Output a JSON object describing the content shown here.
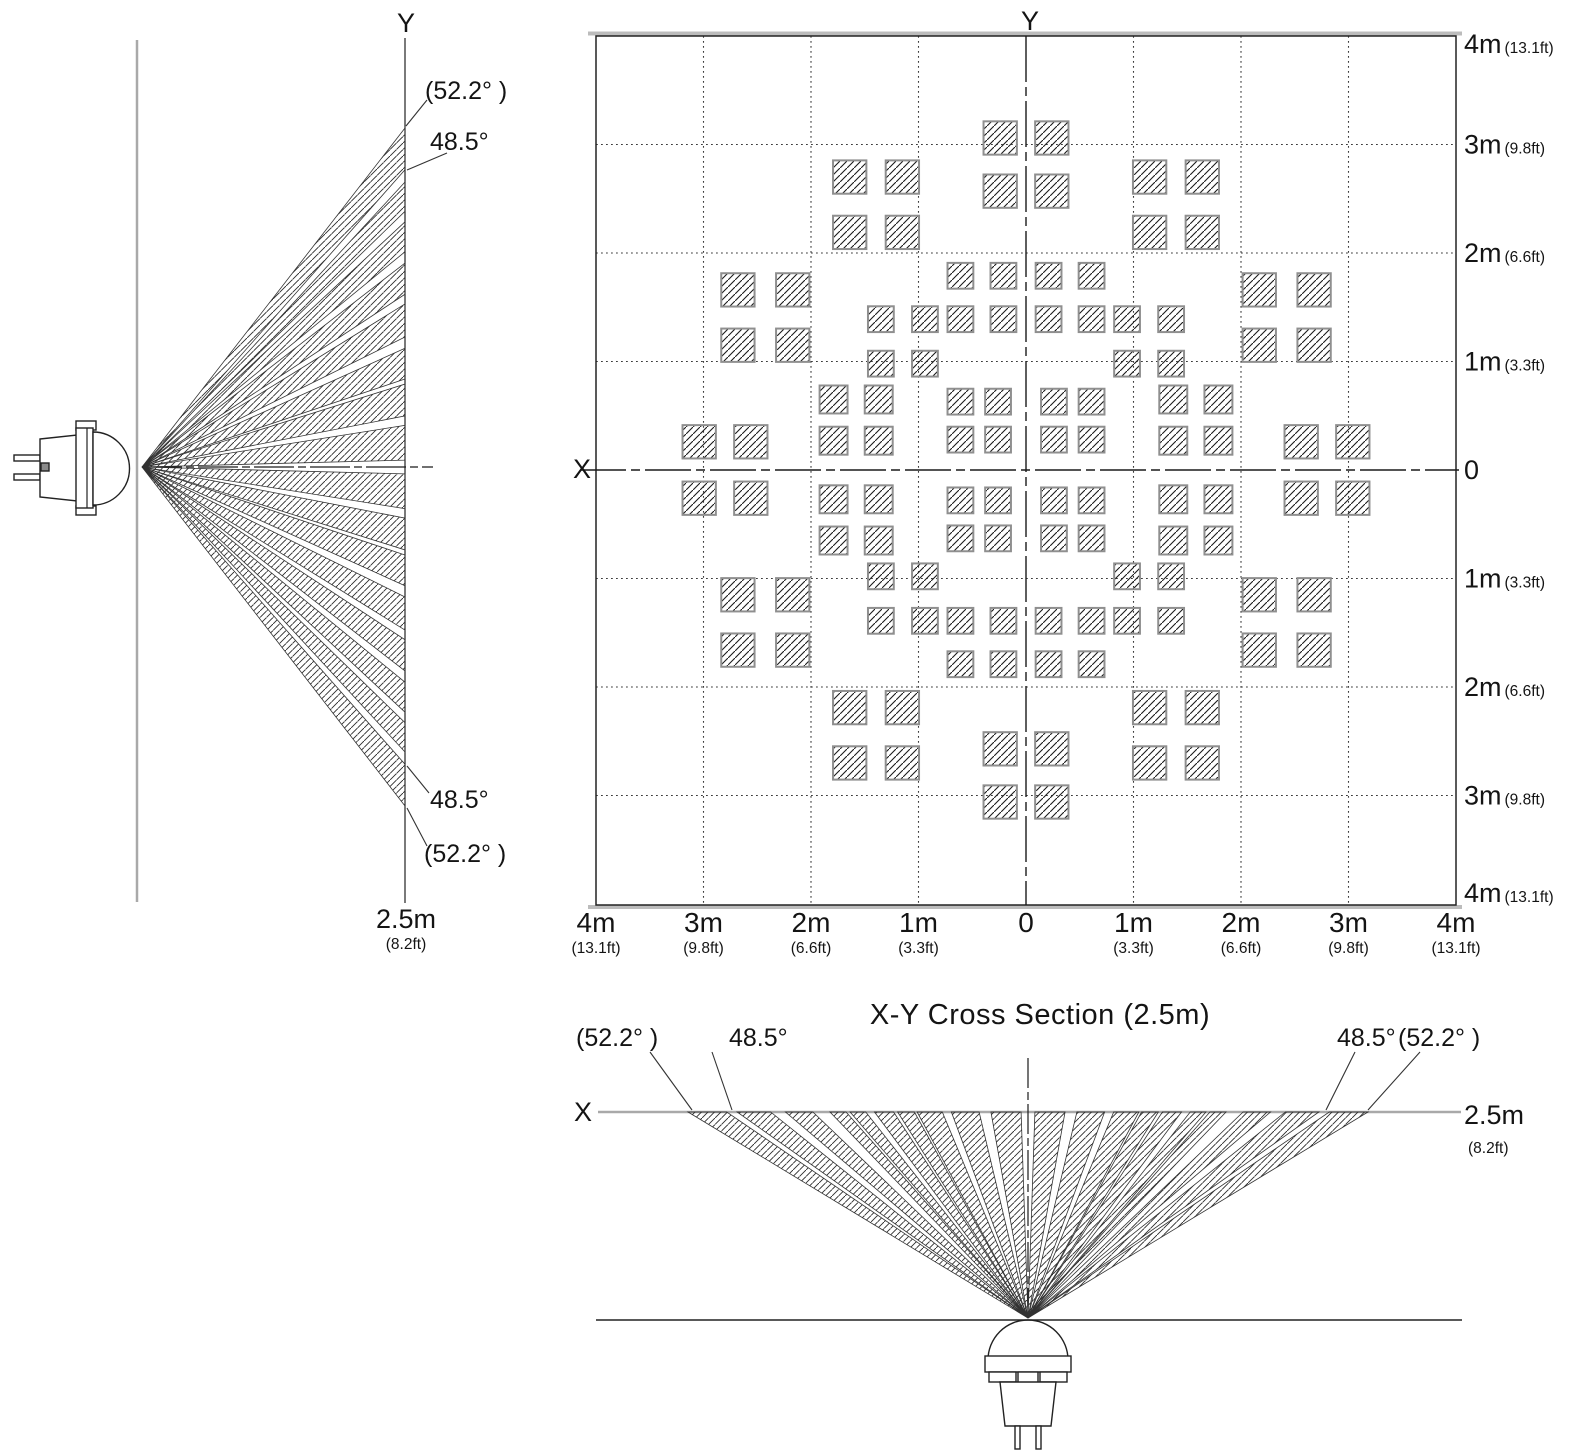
{
  "page": {
    "background": "#ffffff",
    "ink_color": "#1a1a1a",
    "gray_line_color": "#a9a9a9",
    "border_gray_color": "#bcbcbc"
  },
  "side_view": {
    "axis_label": "Y",
    "angle_label_outer": "(52.2° )",
    "angle_label_inner": "48.5°",
    "angle_label_inner_bottom": "48.5°",
    "angle_label_outer_bottom": "(52.2° )",
    "distance_label": "2.5m",
    "distance_label_ft": "(8.2ft)",
    "max_angle_deg": 52.2,
    "inner_angle_deg": 48.5,
    "beam_bands_deg": [
      [
        1.5,
        9.0
      ],
      [
        11.0,
        17.5
      ],
      [
        18.5,
        24.3
      ],
      [
        26.3,
        31.8
      ],
      [
        33.3,
        37.8
      ],
      [
        39.3,
        43.0
      ],
      [
        44.2,
        47.3
      ],
      [
        48.5,
        52.2
      ]
    ]
  },
  "cross_section": {
    "title": "X-Y Cross Section (2.5m)",
    "axis_label_x": "X",
    "axis_label_y": "Y",
    "range_m": 4,
    "grid_step_m": 1,
    "x_tick_labels": [
      {
        "m": "4m",
        "ft": "(13.1ft)"
      },
      {
        "m": "3m",
        "ft": "(9.8ft)"
      },
      {
        "m": "2m",
        "ft": "(6.6ft)"
      },
      {
        "m": "1m",
        "ft": "(3.3ft)"
      },
      {
        "m": "0",
        "ft": ""
      },
      {
        "m": "1m",
        "ft": "(3.3ft)"
      },
      {
        "m": "2m",
        "ft": "(6.6ft)"
      },
      {
        "m": "3m",
        "ft": "(9.8ft)"
      },
      {
        "m": "4m",
        "ft": "(13.1ft)"
      }
    ],
    "y_tick_labels": [
      {
        "m": "4m",
        "ft": "(13.1ft)"
      },
      {
        "m": "3m",
        "ft": "(9.8ft)"
      },
      {
        "m": "2m",
        "ft": "(6.6ft)"
      },
      {
        "m": "1m",
        "ft": "(3.3ft)"
      },
      {
        "m": "0",
        "ft": ""
      },
      {
        "m": "1m",
        "ft": "(3.3ft)"
      },
      {
        "m": "2m",
        "ft": "(6.6ft)"
      },
      {
        "m": "3m",
        "ft": "(9.8ft)"
      },
      {
        "m": "4m",
        "ft": "(13.1ft)"
      }
    ],
    "zone_clusters": [
      {
        "id": "y-axis-outer",
        "xs_m": [
          0.24
        ],
        "ys_m": [
          2.57,
          3.06
        ],
        "square_m": 0.31,
        "mirror_x": true,
        "mirror_y": true
      },
      {
        "id": "diagonal-outer-upper",
        "xs_m": [
          1.15,
          1.64
        ],
        "ys_m": [
          2.19,
          2.7
        ],
        "square_m": 0.31,
        "mirror_x": true,
        "mirror_y": true
      },
      {
        "id": "diagonal-outer-lower",
        "xs_m": [
          2.17,
          2.68
        ],
        "ys_m": [
          1.15,
          1.66
        ],
        "square_m": 0.31,
        "mirror_x": true,
        "mirror_y": true
      },
      {
        "id": "inner-near-y-axis",
        "xs_m": [
          0.21,
          0.61
        ],
        "ys_m": [
          1.39,
          1.79
        ],
        "square_m": 0.24,
        "mirror_x": true,
        "mirror_y": true
      },
      {
        "id": "inner-diagonal",
        "xs_m": [
          0.94,
          1.35
        ],
        "ys_m": [
          0.98,
          1.39
        ],
        "square_m": 0.24,
        "mirror_x": true,
        "mirror_y": true
      },
      {
        "id": "center-cluster",
        "xs_m": [
          0.26,
          0.61
        ],
        "ys_m": [
          0.28,
          0.63
        ],
        "square_m": 0.24,
        "mirror_x": true,
        "mirror_y": true
      },
      {
        "id": "center-side-cluster",
        "xs_m": [
          1.37,
          1.79
        ],
        "ys_m": [
          0.27,
          0.65
        ],
        "square_m": 0.26,
        "mirror_x": true,
        "mirror_y": true
      },
      {
        "id": "x-axis-outer",
        "xs_m": [
          2.56,
          3.04
        ],
        "ys_m": [
          0.26
        ],
        "square_m": 0.31,
        "mirror_x": true,
        "mirror_y": true
      }
    ]
  },
  "bottom_view": {
    "axis_label": "X",
    "angle_label_outer_left": "(52.2° )",
    "angle_label_inner_left": "48.5°",
    "angle_label_inner_right": "48.5°",
    "angle_label_outer_right": "(52.2° )",
    "distance_label": "2.5m",
    "distance_label_ft": "(8.2ft)",
    "max_angle_deg": 52.2,
    "inner_angle_deg": 48.5,
    "beam_bands_deg": [
      [
        1.5,
        8.0
      ],
      [
        10.5,
        16.2
      ],
      [
        18.0,
        22.8
      ],
      [
        23.3,
        26.3
      ],
      [
        27.0,
        30.2
      ],
      [
        31.6,
        34.0
      ],
      [
        34.6,
        36.9
      ],
      [
        39.2,
        42.6
      ],
      [
        44.3,
        47.8
      ],
      [
        48.8,
        52.2
      ]
    ]
  }
}
